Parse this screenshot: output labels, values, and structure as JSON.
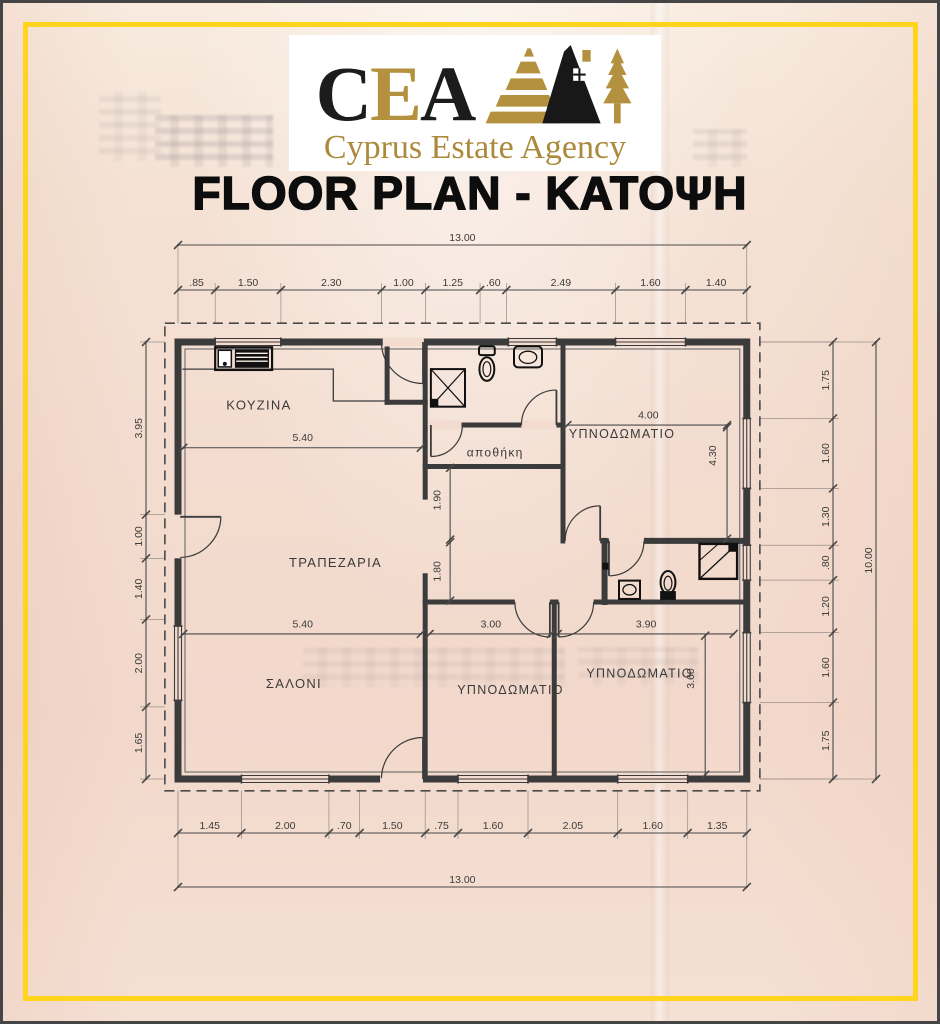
{
  "page": {
    "paper_color": "#f3dccf",
    "frame_color": "#ffd41c",
    "edge_color": "#454545",
    "line_color": "#3b3b3b"
  },
  "logo": {
    "abbr_c": "C",
    "abbr_e": "E",
    "abbr_a": "A",
    "name": "Cyprus Estate Agency",
    "gold": "#b3913f",
    "black": "#1c1c1c",
    "icon": "pyramid-house-tree-icon"
  },
  "title": "FLOOR PLAN - ΚΑΤΟΨΗ",
  "plan": {
    "boundary_style": "dashed",
    "rooms": [
      {
        "id": "kitchen",
        "label": "ΚΟΥΖΙΝΑ"
      },
      {
        "id": "dining",
        "label": "ΤΡΑΠΕΖΑΡΙΑ"
      },
      {
        "id": "living",
        "label": "ΣΑΛΟΝΙ"
      },
      {
        "id": "storage",
        "label": "αποθήκη"
      },
      {
        "id": "bedroom-top-right",
        "label": "ΥΠΝΟΔΩΜΑΤΙΟ"
      },
      {
        "id": "bedroom-bottom-middle",
        "label": "ΥΠΝΟΔΩΜΑΤΙΟ"
      },
      {
        "id": "bedroom-bottom-right",
        "label": "ΥΠΝΟΔΩΜΑΤΙΟ"
      }
    ],
    "fixtures": [
      "kitchen-sink-unit",
      "shower",
      "toilet",
      "washbasin",
      "washbasin",
      "toilet",
      "shower"
    ],
    "dimensions": {
      "top_total": "13.00",
      "top_segments": [
        ".85",
        "1.50",
        "2.30",
        "1.00",
        "1.25",
        ".60",
        "2.49",
        "1.60",
        "1.40"
      ],
      "left_segments": [
        "3.95",
        "1.00",
        "1.40",
        "2.00",
        "1.65"
      ],
      "right_segments": [
        "1.75",
        "1.60",
        "1.30",
        ".80",
        "1.20",
        "1.60",
        "1.75"
      ],
      "right_total": "10.00",
      "bottom_segments": [
        "1.45",
        "2.00",
        ".70",
        "1.50",
        ".75",
        "1.60",
        "2.05",
        "1.60",
        "1.35"
      ],
      "bottom_total": "13.00",
      "interior": [
        {
          "id": "kitchen-width",
          "label": "5.40"
        },
        {
          "id": "living-width",
          "label": "5.40"
        },
        {
          "id": "bedroom-bottom-middle-width",
          "label": "3.00"
        },
        {
          "id": "bedroom-bottom-right-width",
          "label": "3.90"
        },
        {
          "id": "bedroom-top-right-width",
          "label": "4.00"
        },
        {
          "id": "bedroom-top-right-depth",
          "label": "4.30"
        },
        {
          "id": "bedroom-bottom-right-depth",
          "label": "3.60"
        },
        {
          "id": "hall-depth",
          "label": "1.90"
        },
        {
          "id": "hall-opening",
          "label": "1.80"
        }
      ]
    }
  }
}
